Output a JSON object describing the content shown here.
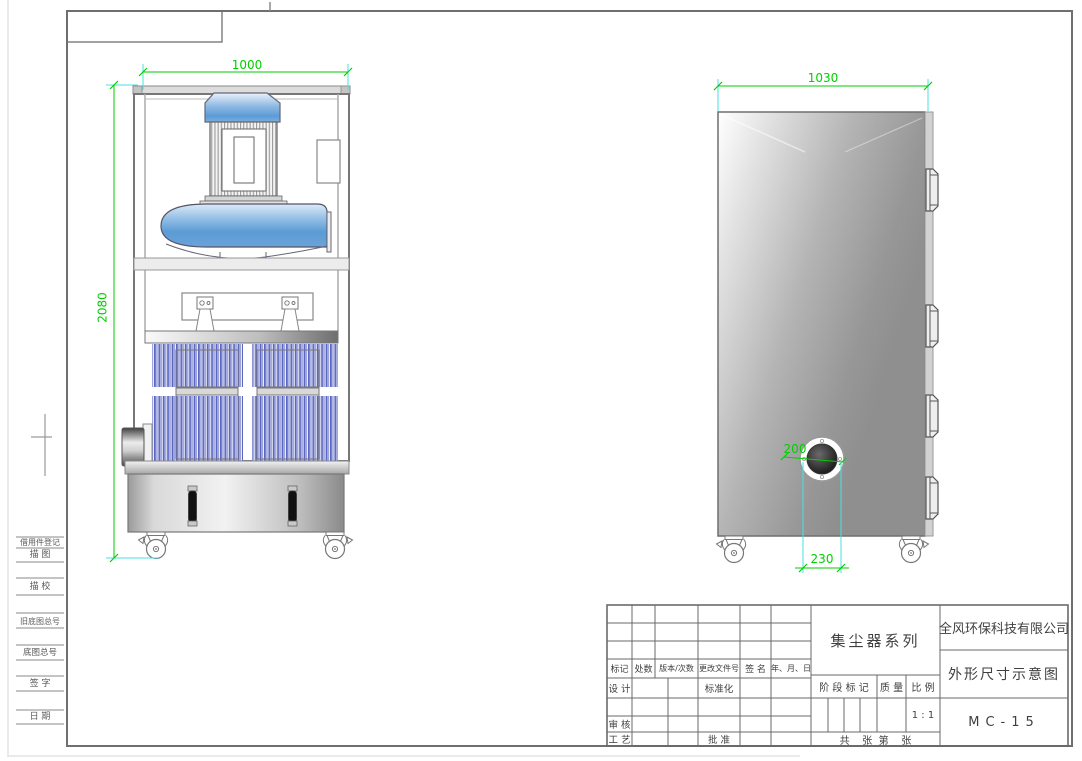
{
  "dimensions": {
    "front_width": "1000",
    "front_height": "2080",
    "side_width": "1030",
    "port_diameter": "200",
    "port_offset": "230"
  },
  "margin_labels": [
    "借用件登记",
    "描 图",
    "描 校",
    "旧底图总号",
    "底图总号",
    "签 字",
    "日 期"
  ],
  "title_block": {
    "revision_headers": [
      "标记",
      "处数",
      "版本/次数",
      "更改文件号",
      "签 名",
      "年、月、日"
    ],
    "design_label": "设 计",
    "standardization_label": "标准化",
    "review_label": "审 核",
    "process_label": "工 艺",
    "approve_label": "批 准",
    "series_title": "集尘器系列",
    "stage_label": "阶 段 标 记",
    "mass_label": "质 量",
    "scale_label": "比 例",
    "scale_value": "1 : 1",
    "sheets_label": "共    张  第    张",
    "company": "全风环保科技有限公司",
    "doc_title": "外形尺寸示意图",
    "model": "MC-15"
  },
  "colors": {
    "dimension_green": "#00cf00",
    "extension_cyan": "#49e2e2",
    "line_gray": "#6f6f6f",
    "machine_blue": "#5b9bd5",
    "filter_blue": "#5b66c0"
  }
}
